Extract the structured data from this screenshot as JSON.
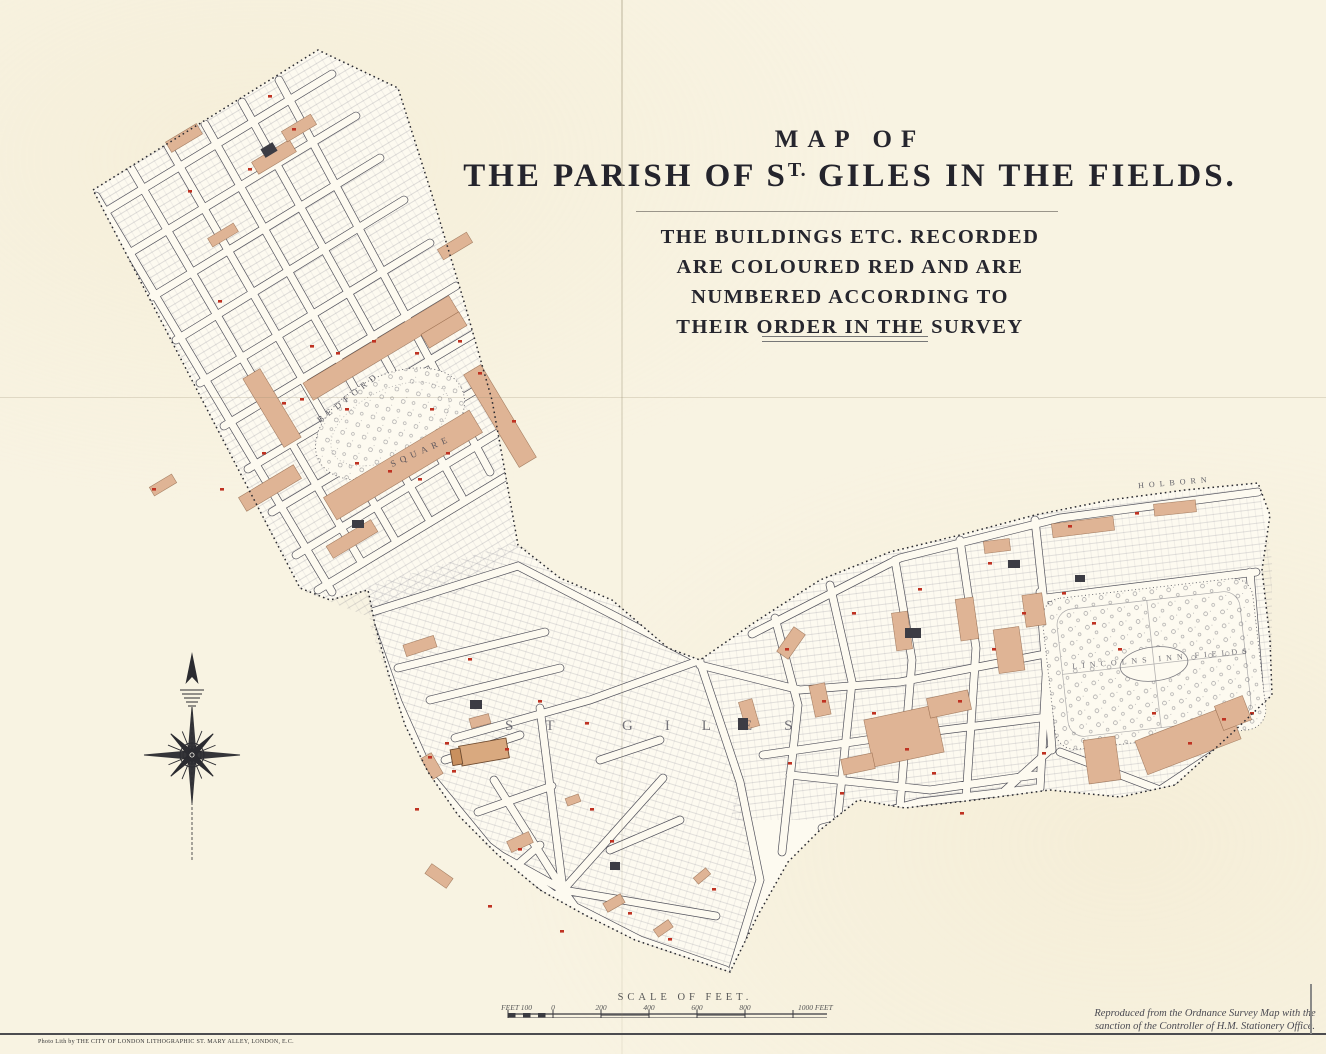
{
  "header": {
    "map_of": "MAP OF",
    "title_pre": "THE PARISH OF S",
    "title_sup": "T.",
    "title_post": " GILES IN THE FIELDS.",
    "subtitle_lines": [
      "THE BUILDINGS ETC. RECORDED",
      "ARE COLOURED RED AND ARE",
      "NUMBERED ACCORDING TO",
      "THEIR ORDER IN THE SURVEY"
    ]
  },
  "scale_bar": {
    "title": "SCALE OF FEET.",
    "left_label": "FEET 100",
    "ticks": [
      "0",
      "200",
      "400",
      "600",
      "800"
    ],
    "right_label": "1000 FEET"
  },
  "attribution": {
    "line1": "Reproduced from the Ordnance Survey Map with the",
    "line2": "sanction of the Controller of H.M. Stationery Office."
  },
  "imprint": "Photo Lith by THE CITY OF LONDON LITHOGRAPHIC ST. MARY ALLEY, LONDON, E.C.",
  "map_labels": {
    "holborn": "HOLBORN",
    "bedford": "BEDFORD",
    "square": "SQUARE",
    "st_giles": "ST GILES",
    "lincolns_inn_fields": "LINCOLNS INN FIELDS"
  },
  "legend_colors": {
    "paper": "#f8f3e2",
    "recorded_building_red": "#dfb495",
    "survey_number_red": "#bf3222",
    "map_ink": "#3d3d46"
  }
}
